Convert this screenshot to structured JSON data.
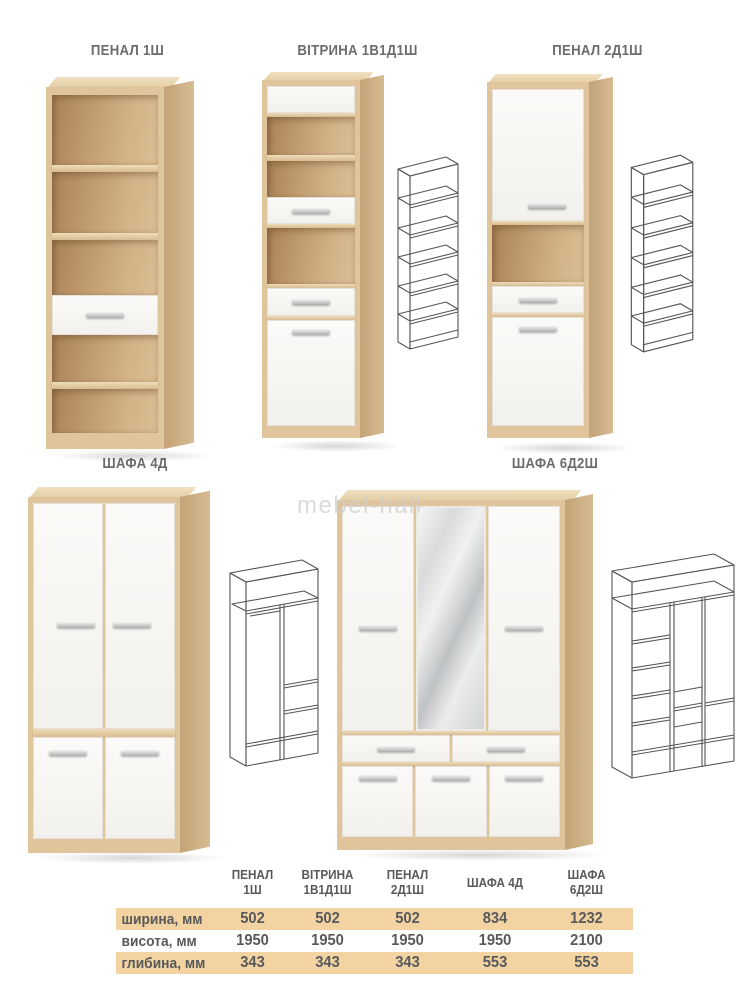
{
  "page": {
    "watermark": "mebel-hall"
  },
  "colors": {
    "oak": "#dcbf95",
    "oak_dark": "#a98256",
    "white_panel": "#f7f6f2",
    "table_stripe": "#f2d3a1",
    "text": "#58595b",
    "label_text": "#6b6c6e",
    "watermark": "#cfcfcf",
    "wireframe_line": "#555555"
  },
  "products": [
    {
      "id": "penal-1sh",
      "label": "ПЕНАЛ 1Ш"
    },
    {
      "id": "vitrina-1v1d1sh",
      "label": "ВІТРИНА 1В1Д1Ш"
    },
    {
      "id": "penal-2d1sh",
      "label": "ПЕНАЛ 2Д1Ш"
    },
    {
      "id": "shafa-4d",
      "label": "ШАФА 4Д"
    },
    {
      "id": "shafa-6d2sh",
      "label": "ШАФА 6Д2Ш"
    }
  ],
  "table": {
    "col_headers": [
      "ПЕНАЛ\n1Ш",
      "ВІТРИНА\n1В1Д1Ш",
      "ПЕНАЛ\n2Д1Ш",
      "ШАФА 4Д",
      "ШАФА\n6Д2Ш"
    ],
    "row_headers": [
      "ширина, мм",
      "висота, мм",
      "глибина, мм"
    ],
    "rows": [
      [
        "502",
        "502",
        "502",
        "834",
        "1232"
      ],
      [
        "1950",
        "1950",
        "1950",
        "1950",
        "2100"
      ],
      [
        "343",
        "343",
        "343",
        "553",
        "553"
      ]
    ]
  }
}
